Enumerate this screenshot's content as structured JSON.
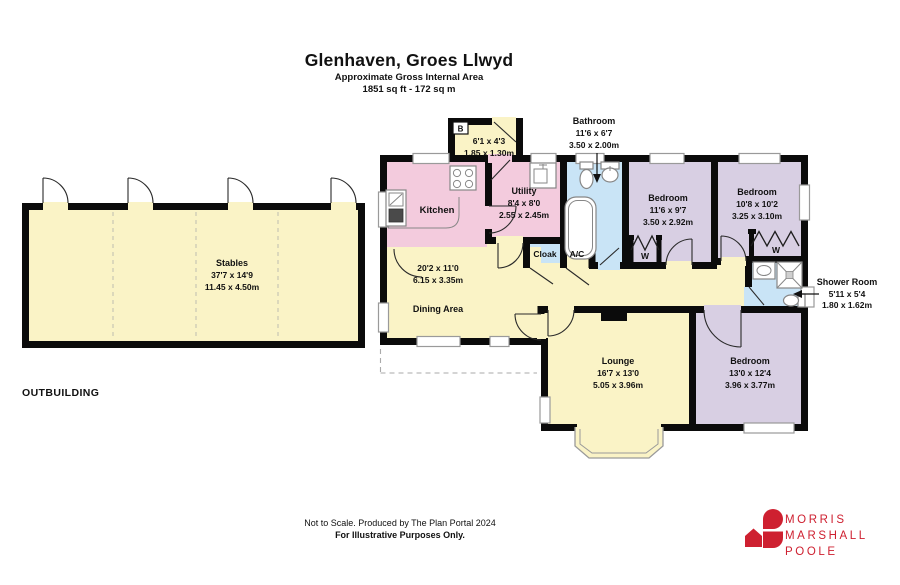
{
  "title": {
    "property": "Glenhaven, Groes Llwyd",
    "subtitle": "Approximate Gross Internal Area",
    "area": "1851 sq ft - 172 sq m"
  },
  "outbuilding": {
    "label": "OUTBUILDING",
    "stables": {
      "name": "Stables",
      "imperial": "37'7 x 14'9",
      "metric": "11.45 x 4.50m"
    }
  },
  "house": {
    "boiler": {
      "tag": "B",
      "imperial": "6'1 x 4'3",
      "metric": "1.85 x 1.30m"
    },
    "kitchen": {
      "name": "Kitchen"
    },
    "utility": {
      "name": "Utility",
      "imperial": "8'4 x 8'0",
      "metric": "2.55 x 2.45m"
    },
    "bathroom": {
      "name": "Bathroom",
      "imperial": "11'6 x 6'7",
      "metric": "3.50 x 2.00m"
    },
    "bedroom1": {
      "name": "Bedroom",
      "imperial": "11'6 x 9'7",
      "metric": "3.50 x 2.92m"
    },
    "bedroom2": {
      "name": "Bedroom",
      "imperial": "10'8 x 10'2",
      "metric": "3.25 x 3.10m"
    },
    "cloak": {
      "name": "Cloak"
    },
    "ac": {
      "name": "A/C"
    },
    "dining": {
      "name": "Dining Area",
      "imperial": "20'2 x 11'0",
      "metric": "6.15 x 3.35m"
    },
    "shower": {
      "name": "Shower Room",
      "imperial": "5'11 x 5'4",
      "metric": "1.80 x 1.62m"
    },
    "lounge": {
      "name": "Lounge",
      "imperial": "16'7 x 13'0",
      "metric": "5.05 x 3.96m"
    },
    "bedroom3": {
      "name": "Bedroom",
      "imperial": "13'0 x 12'4",
      "metric": "3.96 x 3.77m"
    },
    "wardrobe": "W"
  },
  "footer": {
    "line1": "Not to Scale. Produced by The Plan Portal 2024",
    "line2": "For Illustrative Purposes Only."
  },
  "logo": {
    "line1": "MORRIS",
    "line2": "MARSHALL",
    "line3": "POOLE"
  },
  "colors": {
    "room_yellow": "#faf3c6",
    "room_pink": "#f3cbdd",
    "room_blue": "#c9e4f6",
    "room_purple": "#d8cfe3",
    "wall": "#0b0b0b",
    "logo_red": "#ce2030"
  }
}
